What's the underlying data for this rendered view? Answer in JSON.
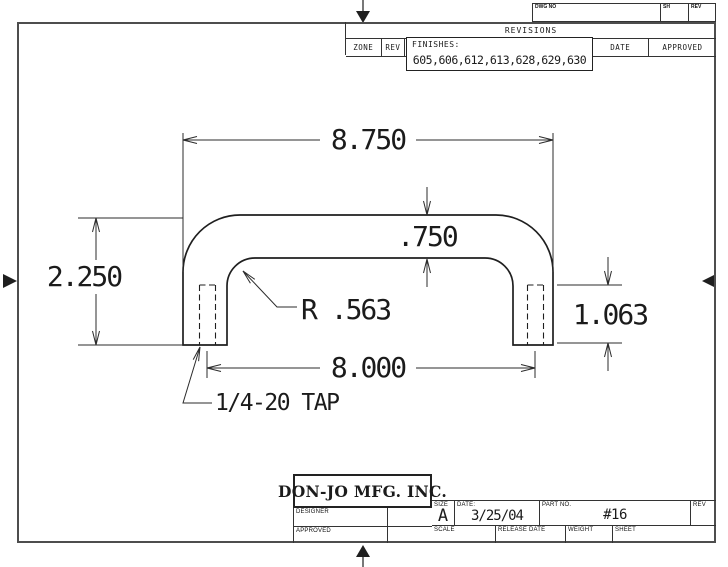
{
  "revisions": {
    "dwg_no_label": "DWG NO",
    "sh_label": "SH",
    "rev_label": "REV",
    "title": "REVISIONS",
    "zone_label": "ZONE",
    "rev_col_label": "REV",
    "date_label": "DATE",
    "approved_label": "APPROVED",
    "finishes_label": "FINISHES:",
    "finishes_values": "605,606,612,613,628,629,630"
  },
  "title_block": {
    "company": "DON-JO MFG. INC.",
    "designer_label": "DESIGNER",
    "approved_label": "APPROVED",
    "size_label": "SIZE",
    "size_value": "A",
    "date_label": "DATE:",
    "date_value": "3/25/04",
    "part_no_label": "PART NO.",
    "part_no_value": "#16",
    "rev_label": "REV",
    "scale_label": "SCALE",
    "release_date_label": "RELEASE DATE",
    "weight_label": "WEIGHT",
    "sheet_label": "SHEET"
  },
  "drawing": {
    "dim_overall_width": "8.750",
    "dim_thickness": ".750",
    "dim_height": "2.250",
    "dim_radius": "R .563",
    "dim_center_to_center": "8.000",
    "dim_leg_height": "1.063",
    "note_tap": "1/4-20 TAP"
  }
}
